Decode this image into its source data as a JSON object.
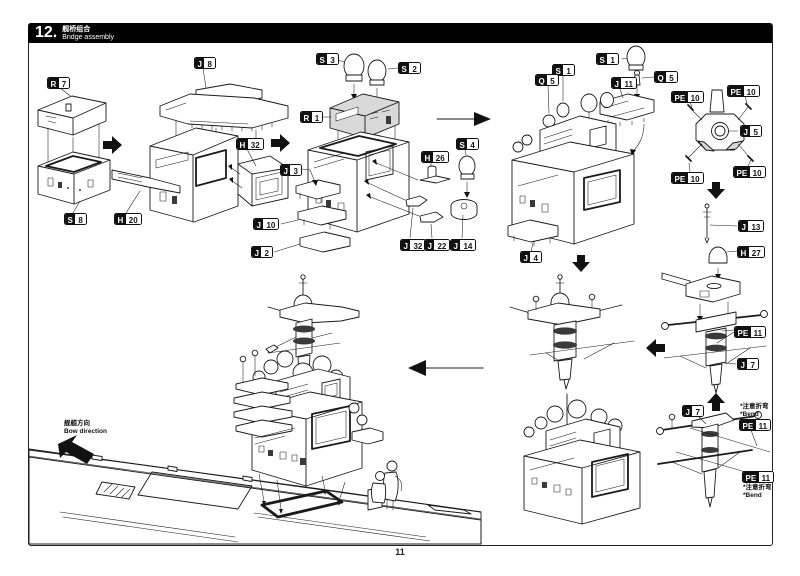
{
  "header": {
    "step_number": "12.",
    "title_zh": "舰桥组合",
    "title_en": "Bridge assembly"
  },
  "page_number": "11",
  "bow_note": {
    "zh": "舰艏方向",
    "en": "Bow direction"
  },
  "bend_note": {
    "zh": "*注意折弯",
    "en": "*Bend"
  },
  "colors": {
    "ink": "#1a1a1a",
    "header_bg": "#000000",
    "part_shade": "#d9d9d9"
  },
  "icons": {
    "arrow_right": "step-arrow-right",
    "arrow_left": "step-arrow-left",
    "arrow_down": "step-arrow-down",
    "arrow_up": "step-arrow-up",
    "arrow_bow": "bow-direction-arrow"
  },
  "labels": {
    "r7": {
      "letter": "R",
      "number": "7"
    },
    "s8": {
      "letter": "S",
      "number": "8"
    },
    "h20": {
      "letter": "H",
      "number": "20"
    },
    "j8": {
      "letter": "J",
      "number": "8"
    },
    "h32": {
      "letter": "H",
      "number": "32"
    },
    "j3": {
      "letter": "J",
      "number": "3"
    },
    "j10": {
      "letter": "J",
      "number": "10"
    },
    "j2": {
      "letter": "J",
      "number": "2"
    },
    "s3": {
      "letter": "S",
      "number": "3"
    },
    "s2": {
      "letter": "S",
      "number": "2"
    },
    "r1": {
      "letter": "R",
      "number": "1"
    },
    "h26": {
      "letter": "H",
      "number": "26"
    },
    "s4": {
      "letter": "S",
      "number": "4"
    },
    "j32": {
      "letter": "J",
      "number": "32"
    },
    "j22": {
      "letter": "J",
      "number": "22"
    },
    "j14": {
      "letter": "J",
      "number": "14"
    },
    "s1a": {
      "letter": "S",
      "number": "1"
    },
    "q5a": {
      "letter": "Q",
      "number": "5"
    },
    "s1b": {
      "letter": "S",
      "number": "1"
    },
    "q5b": {
      "letter": "Q",
      "number": "5"
    },
    "j11": {
      "letter": "J",
      "number": "11"
    },
    "j4": {
      "letter": "J",
      "number": "4"
    },
    "pe10a": {
      "letter": "PE",
      "number": "10"
    },
    "pe10b": {
      "letter": "PE",
      "number": "10"
    },
    "pe10c": {
      "letter": "PE",
      "number": "10"
    },
    "pe10d": {
      "letter": "PE",
      "number": "10"
    },
    "j5": {
      "letter": "J",
      "number": "5"
    },
    "j13": {
      "letter": "J",
      "number": "13"
    },
    "h27": {
      "letter": "H",
      "number": "27"
    },
    "pe11a": {
      "letter": "PE",
      "number": "11"
    },
    "j7a": {
      "letter": "J",
      "number": "7"
    },
    "j7b": {
      "letter": "J",
      "number": "7"
    },
    "pe11b": {
      "letter": "PE",
      "number": "11"
    },
    "pe11c": {
      "letter": "PE",
      "number": "11"
    }
  }
}
